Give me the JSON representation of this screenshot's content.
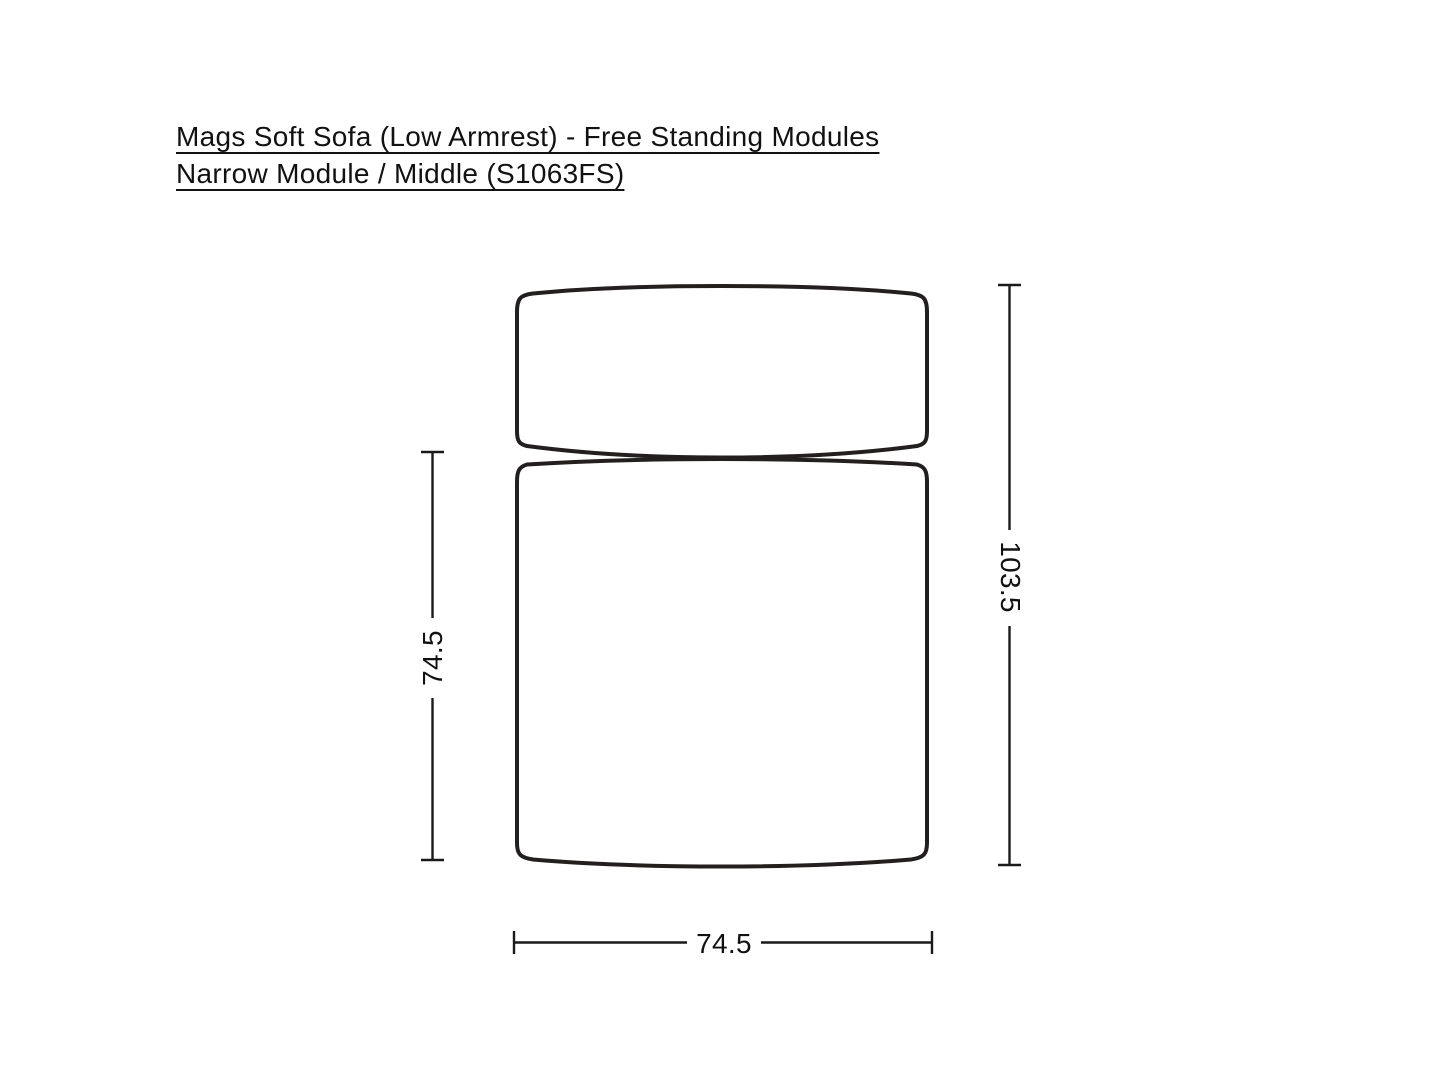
{
  "title": {
    "line1": "Mags Soft Sofa (Low Armrest) - Free Standing Modules",
    "line2": "Narrow Module / Middle (S1063FS)"
  },
  "product": {
    "name": "Mags Soft Sofa (Low Armrest)",
    "collection": "Free Standing Modules",
    "module": "Narrow Module / Middle",
    "code": "S1063FS"
  },
  "dimension_labels": {
    "seat_depth": "74.5",
    "total_depth": "103.5",
    "width": "74.5"
  },
  "colors": {
    "background": "#ffffff",
    "outline": "#231f1e",
    "dimension_line": "#1a1a1a",
    "text": "#111111"
  }
}
